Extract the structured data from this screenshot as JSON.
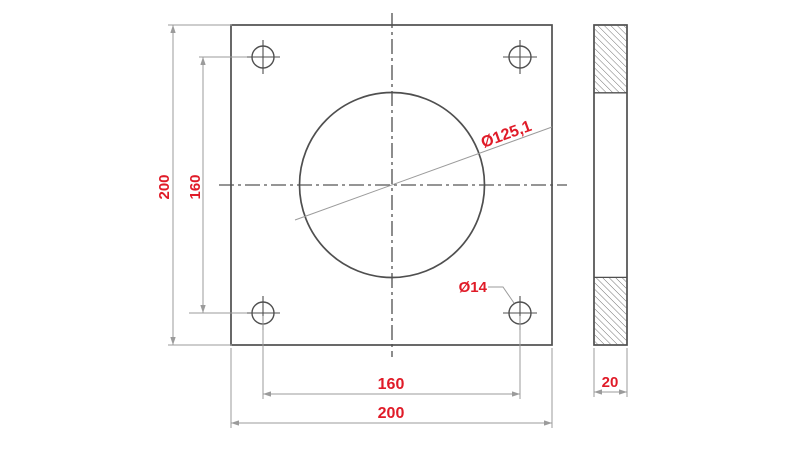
{
  "drawing": {
    "kind": "technical-drawing",
    "subject": "square flange plate with central bore, four bolt holes and side section view",
    "colors": {
      "background": "#ffffff",
      "outline": "#4f4f4f",
      "centerline": "#565656",
      "dimension_line": "#9b9b9b",
      "dimension_text": "#e01b28",
      "hatch": "#6a6a6a"
    },
    "dims": {
      "plate_height": "200",
      "bolt_spacing_vertical": "160",
      "bolt_spacing_horizontal": "160",
      "plate_width": "200",
      "bore_diameter": "Ø125,1",
      "bolt_hole_diameter": "Ø14",
      "thickness": "20"
    }
  }
}
